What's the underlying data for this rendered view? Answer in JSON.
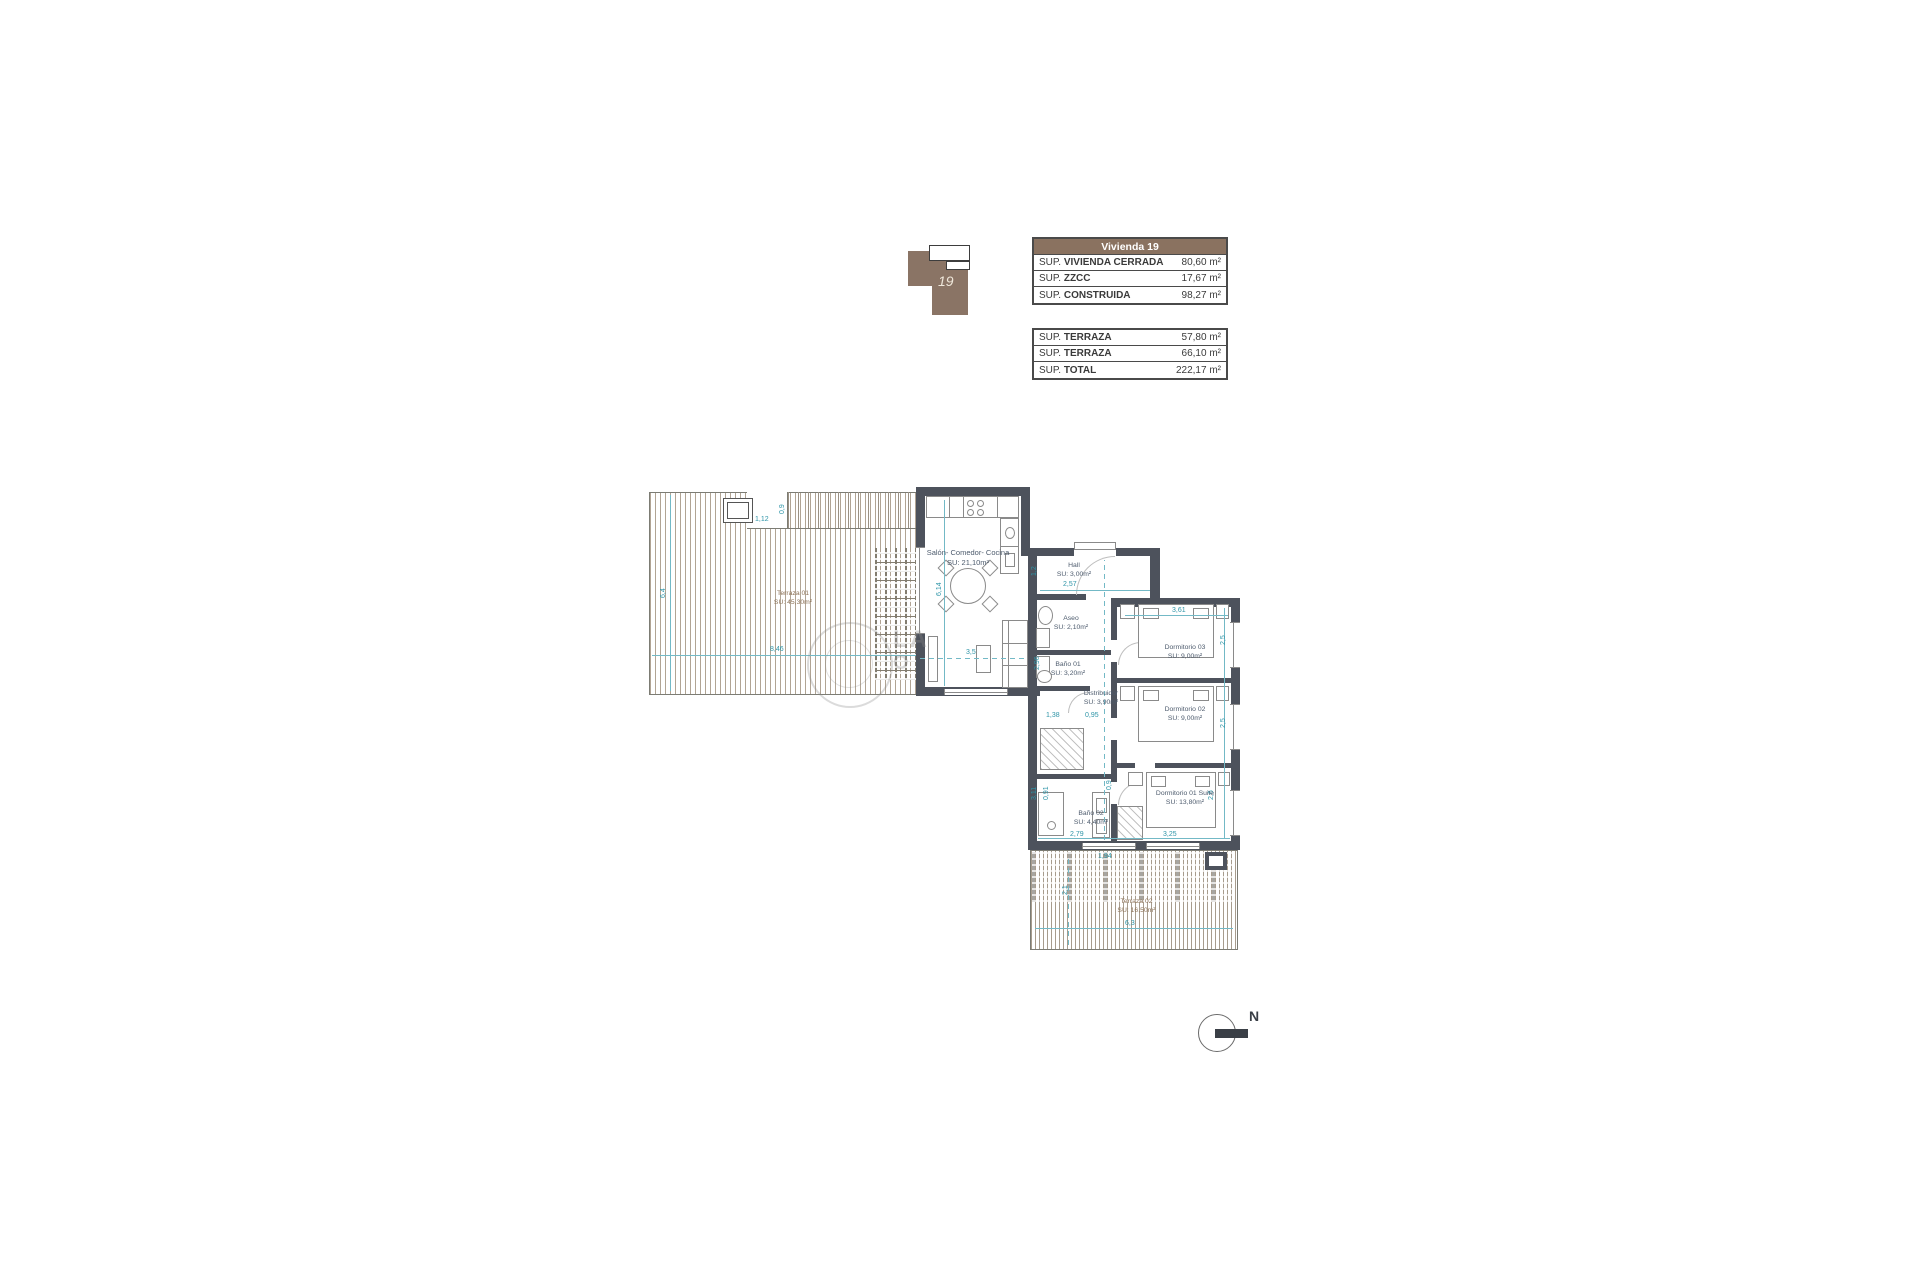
{
  "unit_icon": {
    "number": "19"
  },
  "tables": {
    "main": {
      "header": "Vivienda 19",
      "rows": [
        {
          "prefix": "SUP. ",
          "name": "VIVIENDA CERRADA",
          "value": "80,60 m²"
        },
        {
          "prefix": "SUP. ",
          "name": "ZZCC",
          "value": "17,67 m²"
        },
        {
          "prefix": "SUP. ",
          "name": "CONSTRUIDA",
          "value": "98,27 m²"
        }
      ]
    },
    "secondary": {
      "rows": [
        {
          "prefix": "SUP. ",
          "name": "TERRAZA",
          "value": "57,80 m²"
        },
        {
          "prefix": "SUP. ",
          "name": "TERRAZA",
          "value": "66,10 m²"
        },
        {
          "prefix": "SUP. ",
          "name": "TOTAL",
          "value": "222,17 m²"
        }
      ]
    }
  },
  "rooms": [
    {
      "name": "Salón- Comedor- Cocina",
      "area": "SU: 21,10m²"
    },
    {
      "name": "Hall",
      "area": "SU: 3,00m²"
    },
    {
      "name": "Aseo",
      "area": "SU: 2,10m²"
    },
    {
      "name": "Baño 01",
      "area": "SU: 3,20m²"
    },
    {
      "name": "Distribuidor",
      "area": "SU: 3,90m²"
    },
    {
      "name": "Dormitorio 03",
      "area": "SU: 9,00m²"
    },
    {
      "name": "Dormitorio 02",
      "area": "SU: 9,00m²"
    },
    {
      "name": "Dormitorio 01 Suite",
      "area": "SU: 13,80m²"
    },
    {
      "name": "Baño 02",
      "area": "SU: 4,40m²"
    },
    {
      "name": "Terraza 01",
      "area": "SU: 45,30m²"
    },
    {
      "name": "Terraza 02",
      "area": "SU: 16,50m²"
    }
  ],
  "dims": {
    "d0": "1,12",
    "d1": "0,9",
    "d2": "8,46",
    "d3": "6,4",
    "d4": "6,14",
    "d5": "3,5",
    "d6": "1,2",
    "d7": "2,57",
    "d8": "2,96",
    "d9": "1,38",
    "d10": "0,95",
    "d11": "3,61",
    "d12": "2,5",
    "d13": "2,5",
    "d14": "3,25",
    "d15": "2,6",
    "d16": "3,11",
    "d17": "0,91",
    "d18": "2,79",
    "d19": "0,9",
    "d20": "1,94",
    "d21": "6,3",
    "d22": "2,1"
  },
  "north": {
    "label": "N"
  },
  "watermark": {
    "line1": "LA",
    "line2": "O"
  },
  "colors": {
    "wall": "#4d525c",
    "accent_brown": "#8a7260",
    "dim_teal": "#2f95a8",
    "deck_line": "#b1a494",
    "room_text": "#4d5b6d",
    "terrace_text": "#8d7257"
  }
}
